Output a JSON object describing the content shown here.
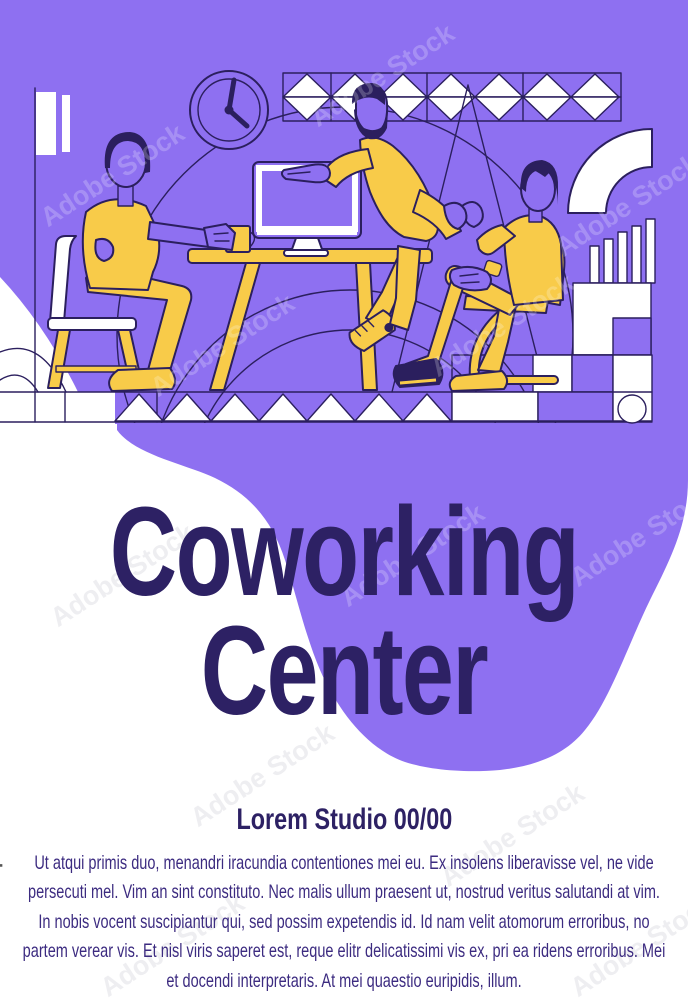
{
  "poster": {
    "title_line1": "Coworking",
    "title_line2": "Center",
    "studio_line": "Lorem Studio 00/00",
    "body_paragraph": "Ut atqui primis duo, menandri iracundia contentiones mei eu. Ex insolens liberavisse vel, ne vide persecuti mel. Vim an sint constituto. Nec malis ullum praesent ut, nostrud veritus salutandi at vim. In nobis vocent suscipiantur qui, sed possim expetendis id. Id nam velit atomorum erroribus, no partem verear vis. Et nisl viris saperet est, reque elitr delicatissimi vis ex, pri ea ridens erroribus. Mei et docendi interpretaris. At mei quaestio euripidis, illum."
  },
  "watermark": {
    "vertical_label": "Adobe Stock | #339489958",
    "tile_label": "Adobe Stock"
  },
  "colors": {
    "purple": "#8e70f1",
    "yellow": "#f8cb49",
    "outline": "#2b1f5e",
    "title": "#2d2164",
    "body": "#3c2b80",
    "white": "#ffffff"
  },
  "illustration": {
    "scene": "three people talking at a coworking desk with computer",
    "elements": [
      "wall-clock",
      "triangle-banner",
      "quarter-arc",
      "bar-chart",
      "shelf-blocks",
      "checkerboard",
      "zigzag-border",
      "desk",
      "computer-monitor",
      "coffee-mug",
      "seated-man-left",
      "standing-man",
      "seated-man-right",
      "chairs",
      "background-blob"
    ]
  }
}
